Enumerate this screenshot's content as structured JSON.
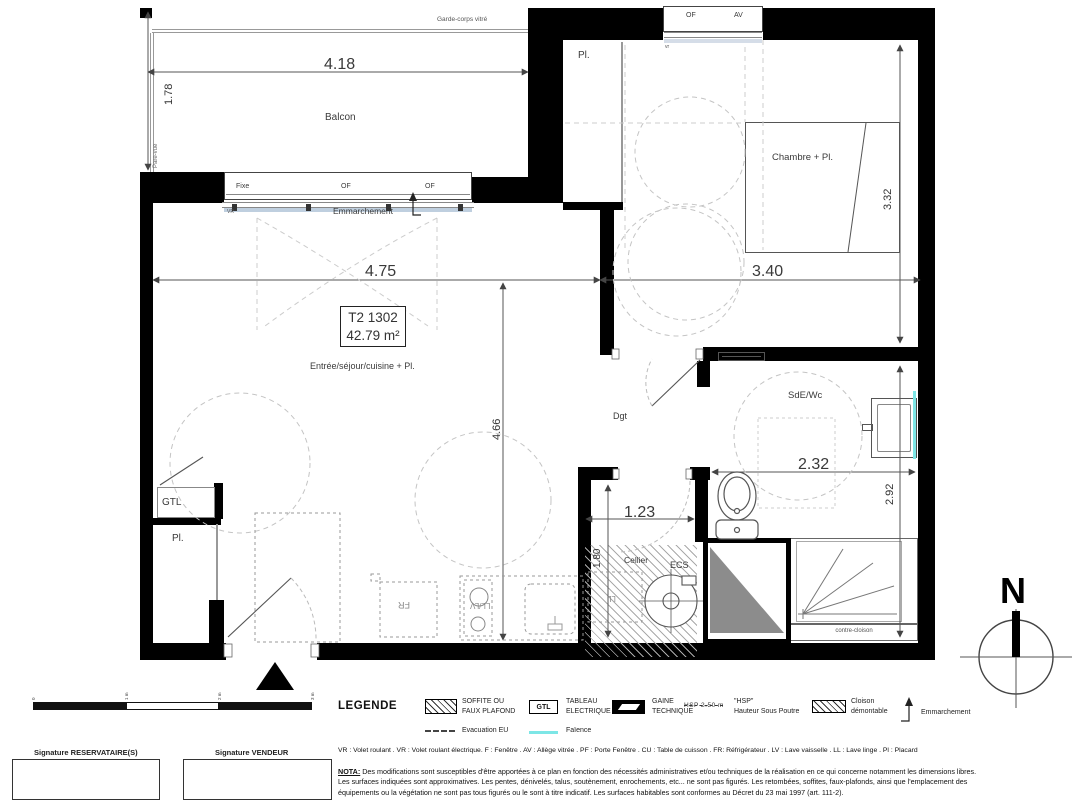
{
  "plan": {
    "unit": {
      "code": "T2 1302",
      "area": "42.79 m²"
    },
    "rooms": {
      "balcon": "Balcon",
      "chambre": "Chambre + Pl.",
      "sejour": "Entrée/séjour/cuisine + Pl.",
      "dgt": "Dgt",
      "sde": "SdE/Wc",
      "cellier": "Cellier",
      "gtl": "GTL",
      "pl_entry": "Pl.",
      "pl_chambre": "Pl."
    },
    "annotations": {
      "garde_corps": "Garde-corps vitré",
      "pare_vue": "Pare-vue",
      "emmarchement": "Emmarchement",
      "contre_cloison": "contre-cloison",
      "ecs": "ECS",
      "ll": "LL",
      "fr": "FR",
      "ll_lv": "LL/LV",
      "vr_lower": "VR",
      "vr_upper": "vr"
    },
    "windows": {
      "fixe": "Fixe",
      "of_left": "OF",
      "of_right": "OF",
      "of_top": "OF",
      "av_top": "AV"
    },
    "dimensions": {
      "balcony_width": "4.18",
      "balcony_depth": "1.78",
      "sejour_width": "4.75",
      "chambre_width": "3.40",
      "sejour_depth": "4.66",
      "chambre_depth": "3.32",
      "sde_width": "2.32",
      "sde_depth": "2.92",
      "cellier_width": "1.23",
      "cellier_depth": "1.80"
    },
    "compass": "N",
    "scale_ticks": [
      "0",
      "1 m",
      "2 m",
      "3 m"
    ]
  },
  "legend": {
    "title": "LEGENDE",
    "items": [
      {
        "line1": "SOFFITE OU",
        "line2": "FAUX PLAFOND"
      },
      {
        "symbol_text": "GTL",
        "line1": "TABLEAU",
        "line2": "ELECTRIQUE"
      },
      {
        "line1": "GAINE",
        "line2": "TECHNIQUE"
      },
      {
        "symbol_text": "HSP 2.50 m",
        "line1": "\"HSP\"",
        "line2": "Hauteur Sous Poutre"
      },
      {
        "line1": "Cloison",
        "line2": "démontable"
      },
      {
        "line1": "Emmarchement",
        "line2": ""
      }
    ],
    "row2": [
      {
        "label": "Evacuation EU"
      },
      {
        "label": "Faïence"
      }
    ]
  },
  "abbreviations": "VR : Volet roulant . VR : Volet roulant électrique. F : Fenêtre . AV : Allège vitrée . PF : Porte Fenêtre . CU : Table de cuisson . FR: Réfrigérateur . LV : Lave vaisselle . LL : Lave linge . Pl : Placard",
  "nota": {
    "label": "NOTA:",
    "line1": " Des modifications sont susceptibles d'être apportées à ce plan en fonction des nécessités administratives et/ou techniques de la réalisation en ce qui concerne notamment les dimensions libres.",
    "line2": "Les surfaces indiquées sont approximatives. Les pentes, dénivelés, talus, soutènement, enrochements, etc... ne sont pas figurés. Les retombées, soffites, faux-plafonds, ainsi que l'emplacement des",
    "line3": "équipements ou la végétation ne sont pas tous figurés ou le sont à titre indicatif. Les surfaces habitables sont conformes au Décret du 23 mai 1997 (art. 111-2)."
  },
  "signatures": {
    "reservataire": "Signature RESERVATAIRE(S)",
    "vendeur": "Signature VENDEUR"
  },
  "colors": {
    "wall": "#000000",
    "faience": "#7de6e6",
    "gaine_fill": "#8c8c8c"
  }
}
